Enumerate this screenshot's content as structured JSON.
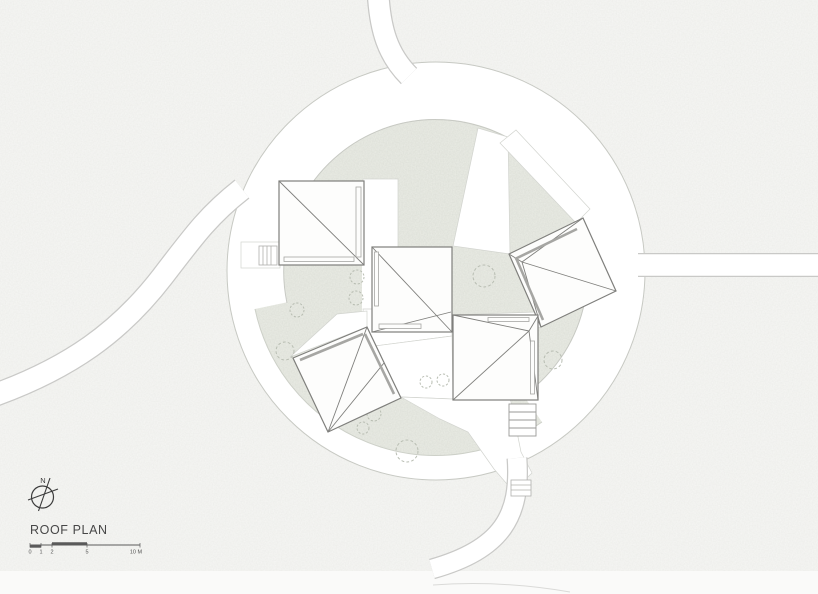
{
  "drawing": {
    "title": "ROOF PLAN",
    "compass": {
      "north_label": "N"
    },
    "scale_bar": {
      "labels": [
        "0",
        "1",
        "2",
        "5",
        "10 M"
      ]
    },
    "colors": {
      "paper": "#f7f7f5",
      "ring": "#ffffff",
      "courtyard": "#ebede6",
      "light_line": "#c7c9c3",
      "path_line": "#c9c9c7",
      "building_line": "#7f7f7c",
      "strip_line": "#a6a6a3",
      "tree_line": "#b8bdb2",
      "text": "#474747"
    },
    "elements": {
      "roof_count": "5",
      "site_shape": "circular plaza with radiating paths"
    }
  }
}
